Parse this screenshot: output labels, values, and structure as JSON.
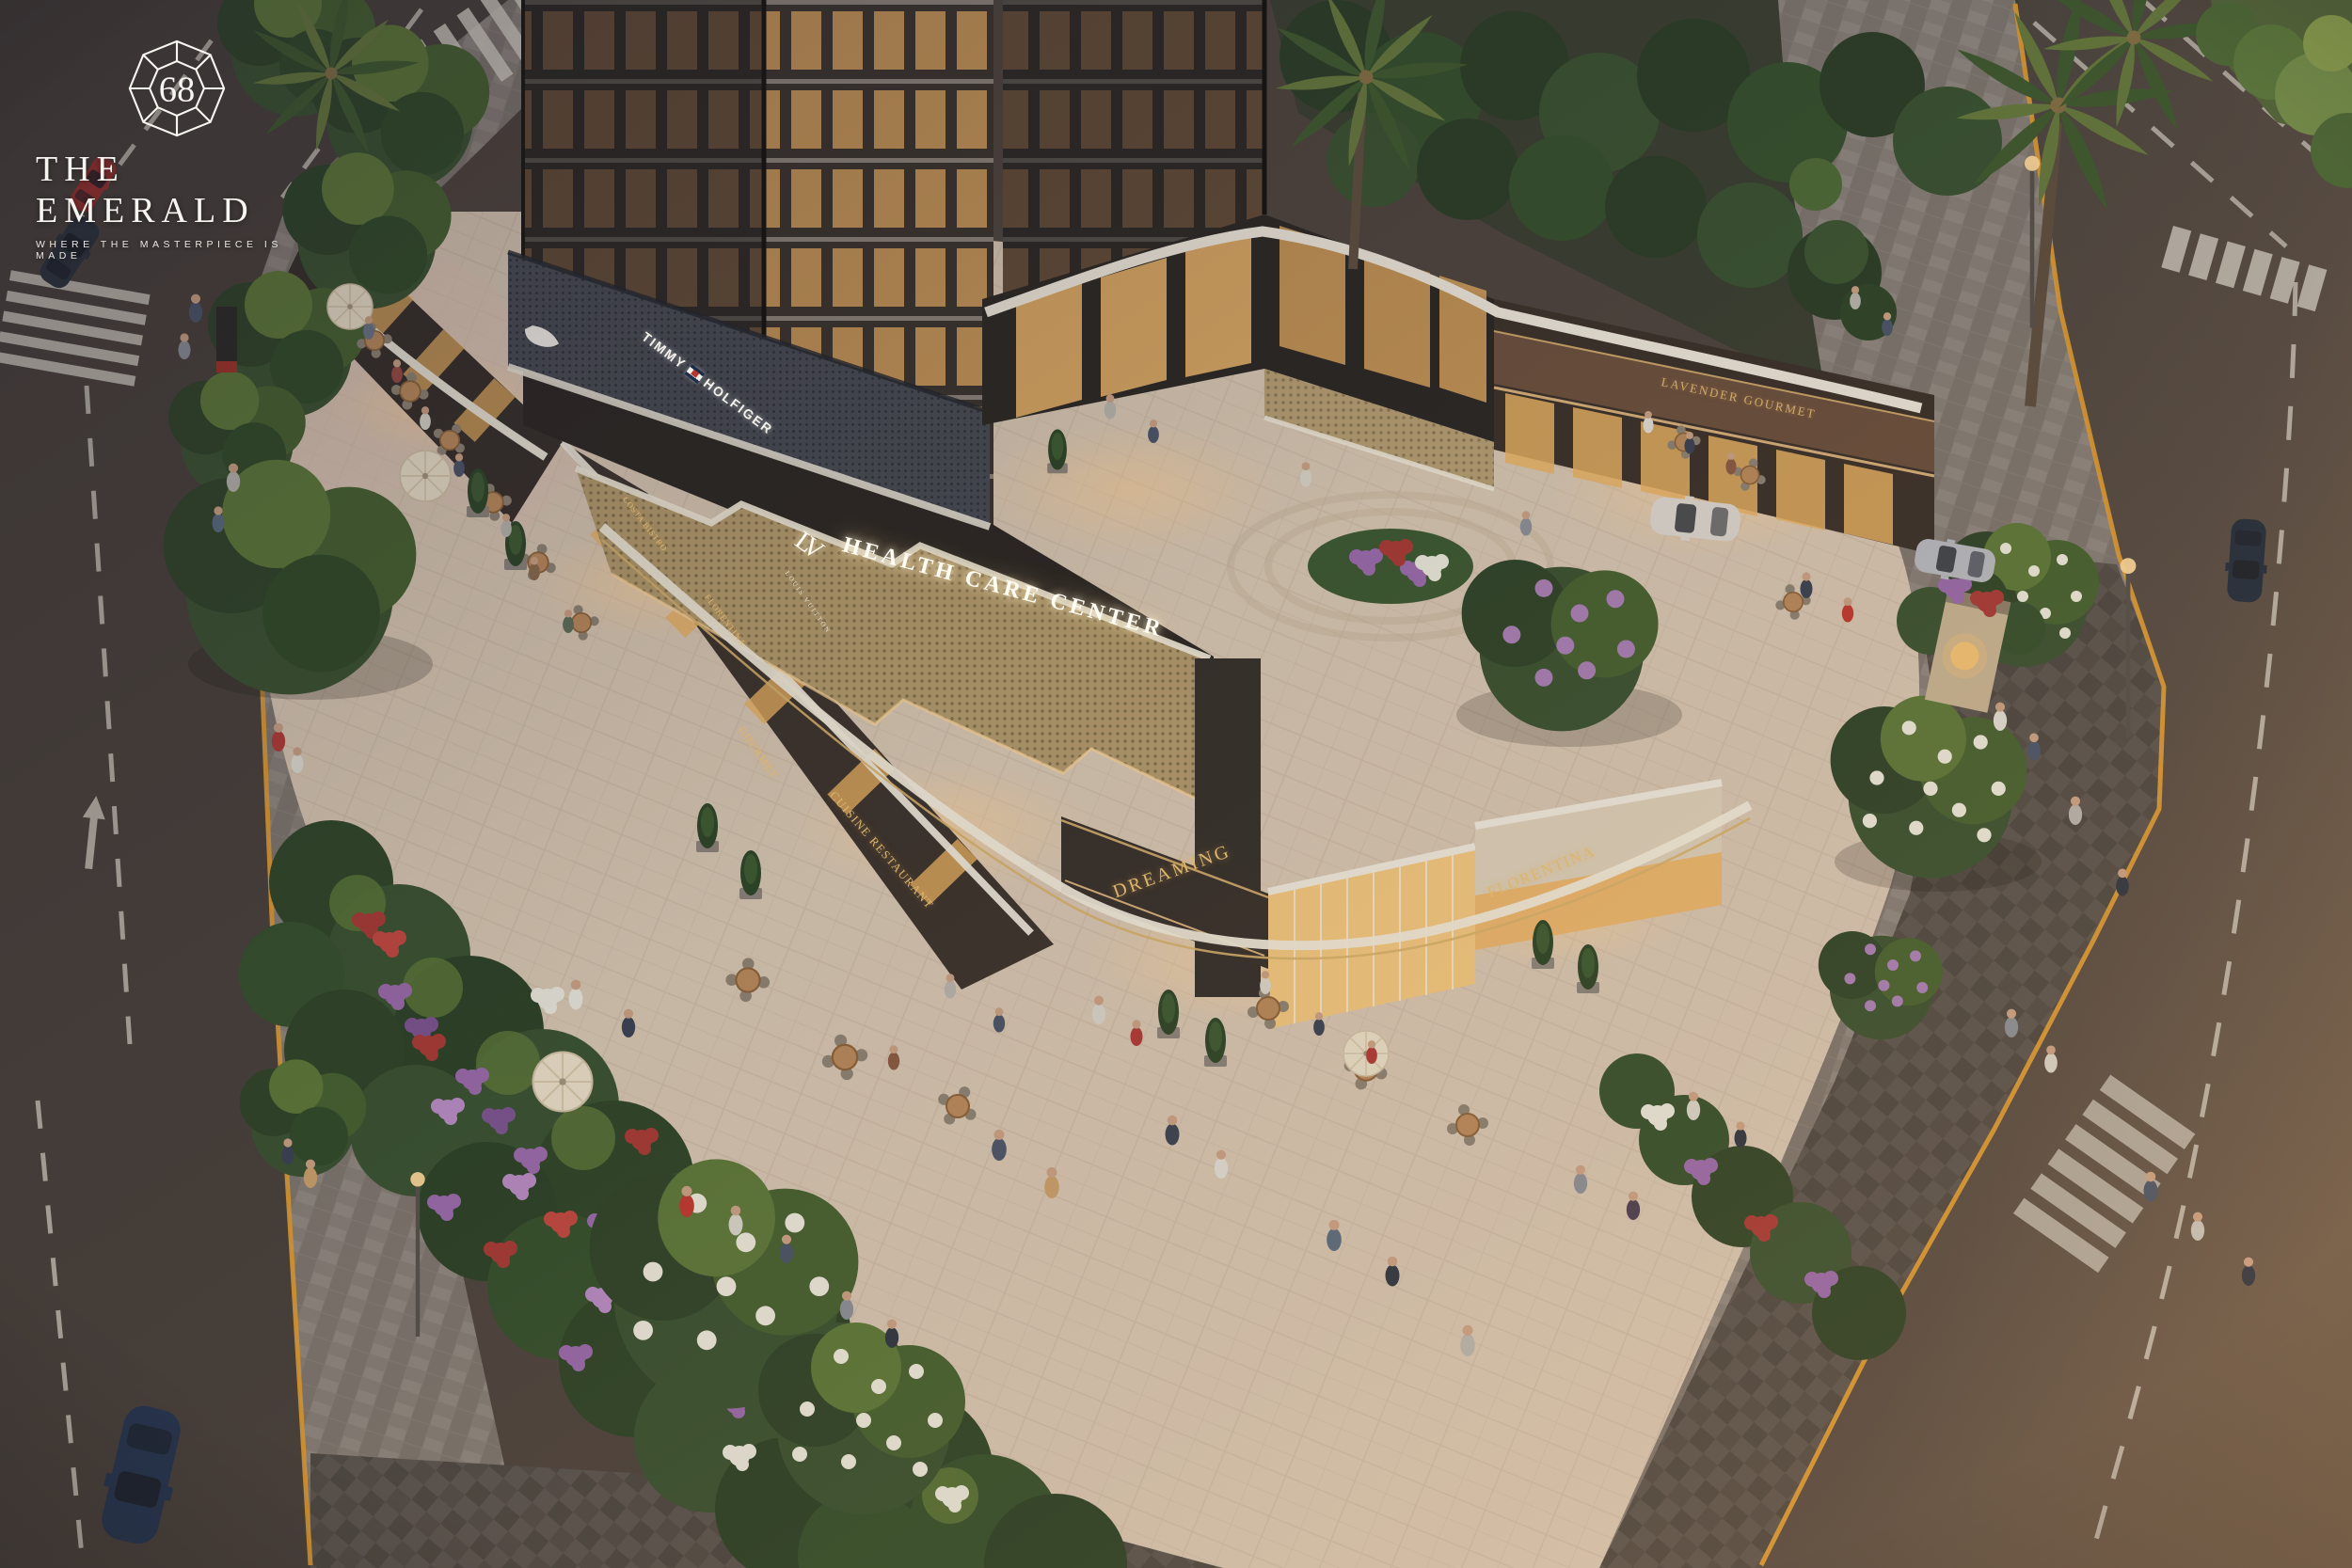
{
  "logo": {
    "number": "68",
    "name": "THE EMERALD",
    "tagline": "WHERE THE MASTERPIECE IS MADE"
  },
  "signs": {
    "fashion_word1": "TIMMY",
    "fashion_word2": "HOLFIGER",
    "health_care": "HEALTH CARE CENTER",
    "monogram": "LV",
    "monogram_label": "LOUIS VUITTON",
    "costa_bistro": "COSTA BISTRO",
    "florentina_left": "FLORENTINA",
    "gourmet": "GOURMET",
    "cuisine_restaurant": "CUISINE RESTAURANT",
    "dreaming": "DREAMING",
    "florentina_corner": "FLORENTINA",
    "lavender_gourmet": "LAVENDER GOURMET"
  },
  "icons": {
    "gem": "emerald-gem-outline",
    "flag": "tommy-flag",
    "sportswear": "leaping-cat-logo"
  },
  "colors": {
    "sign_gold": "#d9b56a",
    "glow_white": "#fff8e6",
    "road_yellow": "#dd9a33",
    "plaza_paving": "#d7c6b1",
    "asphalt": "#4e443d",
    "flower_purple": "#9a6aaa",
    "flower_red": "#a83a35",
    "foliage_green": "#3a5230",
    "facade_dark": "#2c2824",
    "window_amber": "#e3aa5f"
  }
}
